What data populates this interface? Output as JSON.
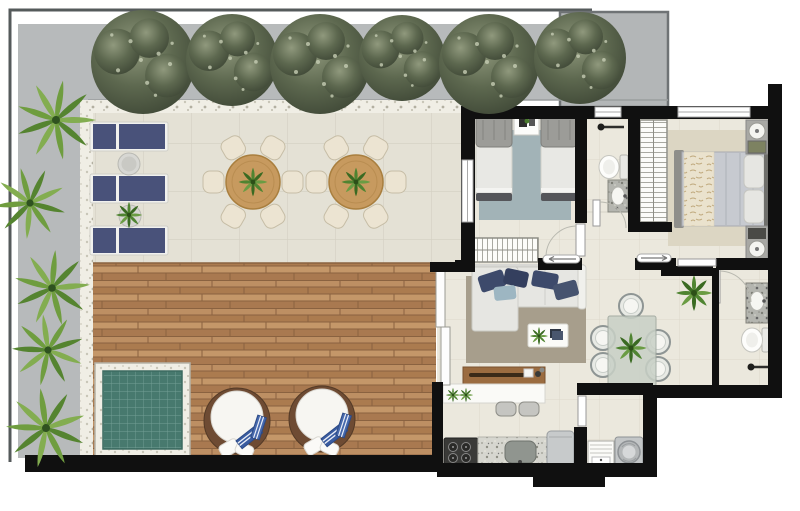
{
  "canvas": {
    "width": 800,
    "height": 511,
    "kind": "rendered-floor-plan",
    "visible_text": []
  },
  "palette": {
    "wall": "#101010",
    "outline": "#555a5b",
    "path_gray": "#b7babb",
    "planter_border": "#6f7375",
    "terrace_tile": "#e4e1d5",
    "interior_tile": "#ebe8dd",
    "deck_wood": "#b5855a",
    "deck_line": "#8a6240",
    "pool_water": "#47796e",
    "pool_grout": "#73a095",
    "lounger_navy": "#49527a",
    "table_wood": "#c79a5f",
    "chair_cream": "#ece4d2",
    "daybed_base": "#6e4b33",
    "towel_blue": "#3a5ca0",
    "rug_bedroom": "#a2b3b7",
    "rug_living": "#a79e8c",
    "rug_master": "#dcd6c3",
    "sofa_gray": "#e6e6e2",
    "pillow_navy": "#3d4a6b",
    "pillow_blue": "#9db6c2",
    "bar_wood": "#9b6c40",
    "glass_table": "#c8d0c6",
    "stove_dark": "#3a3a38",
    "appliance_gray": "#c7cacb",
    "fixture_white": "#fdfdfb"
  },
  "inventory": {
    "outdoor": {
      "hedge_trees": 6,
      "palm_plants": 5,
      "sun_loungers": 3,
      "lounger_side_tables": 2,
      "round_dining_tables": 2,
      "chairs_per_round_table": 6,
      "round_daybeds": 2,
      "plunge_pool": 1,
      "wood_deck": 1,
      "tiled_terrace": 1
    },
    "rooms": [
      {
        "name": "twin-bedroom",
        "furniture": [
          "twin-bed",
          "twin-bed",
          "nightstand",
          "blue-rug",
          "hatched-wardrobe",
          "window"
        ]
      },
      {
        "name": "bathroom-top",
        "furniture": [
          "toilet",
          "granite-sink-counter",
          "towel-rail",
          "window",
          "door"
        ]
      },
      {
        "name": "master-closet",
        "furniture": [
          "hatched-shelving"
        ]
      },
      {
        "name": "master-bedroom",
        "furniture": [
          "double-bed",
          "nightstand-with-lamp",
          "nightstand-with-lamp",
          "beige-rug",
          "window",
          "sliding-door"
        ]
      },
      {
        "name": "living-room",
        "furniture": [
          "l-shaped-sofa",
          "coffee-table",
          "taupe-rug",
          "wood-sideboard-bar",
          "bar-counter",
          "bar-stool",
          "bar-stool",
          "sliding-glass-door"
        ]
      },
      {
        "name": "dining-area",
        "furniture": [
          "glass-table",
          "wire-chair",
          "wire-chair",
          "wire-chair",
          "wire-chair",
          "wire-chair",
          "potted-plant"
        ]
      },
      {
        "name": "kitchen",
        "furniture": [
          "4-burner-stove",
          "granite-counter-with-sink",
          "fridge"
        ]
      },
      {
        "name": "laundry",
        "furniture": [
          "wash-tank",
          "washing-machine",
          "door"
        ]
      },
      {
        "name": "bathroom-right",
        "furniture": [
          "granite-sink-counter",
          "toilet",
          "towel-rail",
          "door"
        ]
      }
    ]
  }
}
